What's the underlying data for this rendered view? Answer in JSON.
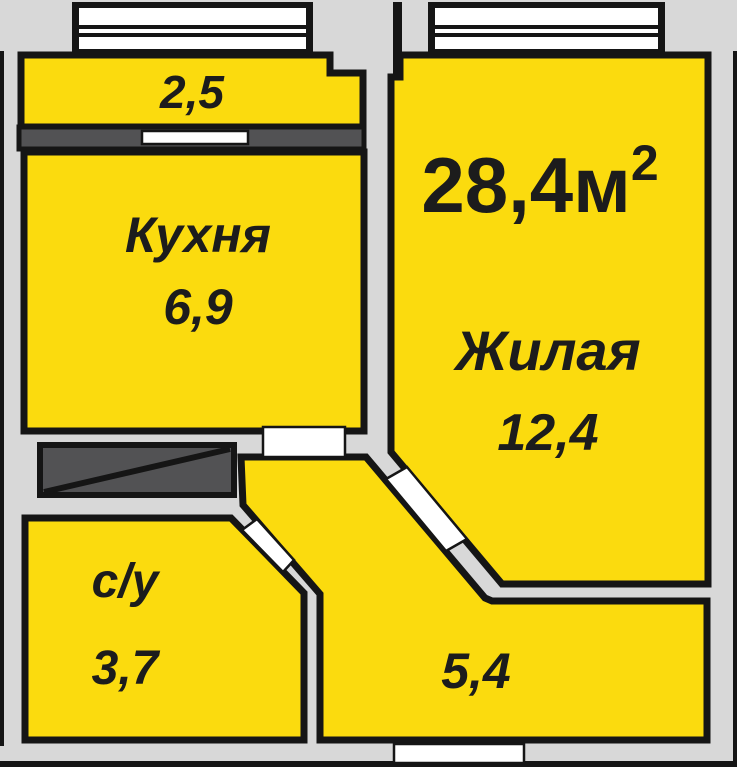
{
  "plan_title": "Однокомнатная квартира — план",
  "total_area": {
    "value": "28,4м",
    "sup": "2"
  },
  "rooms": {
    "balcony": {
      "area": "2,5"
    },
    "kitchen": {
      "name": "Кухня",
      "area": "6,9"
    },
    "living": {
      "name": "Жилая",
      "area": "12,4"
    },
    "bathroom": {
      "name": "с/у",
      "area": "3,7"
    },
    "hallway": {
      "area": "5,4"
    }
  },
  "colors": {
    "background": "#d8d8d8",
    "room": "#fbdb0e",
    "outline": "#151515",
    "wall_dark": "#525254",
    "opening": "#ffffff",
    "text": "#1c1c1c"
  }
}
